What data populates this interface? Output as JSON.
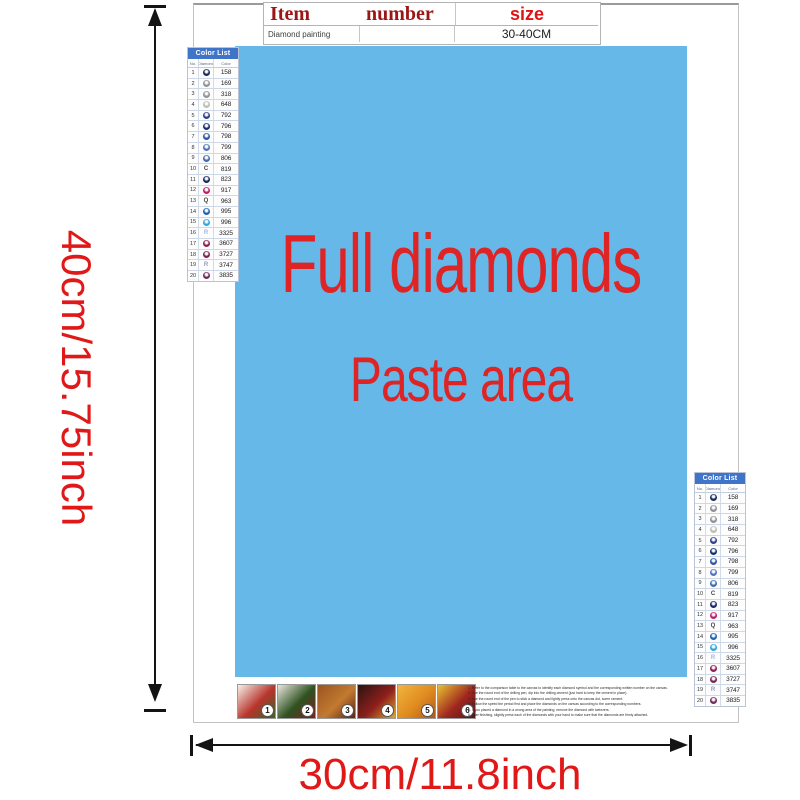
{
  "item_table": {
    "col_item": "Item",
    "col_number": "number",
    "col_size": "size",
    "row_item": "Diamond painting",
    "row_number": "",
    "row_size": "30-40CM"
  },
  "paste_area": {
    "line1": "Full diamonds",
    "line2": "Paste area",
    "bg_color": "#65b8e7",
    "text_color": "#de2424"
  },
  "dimensions": {
    "height": "40cm/15.75inch",
    "width": "30cm/11.8inch",
    "label_color": "#e01818"
  },
  "color_list": {
    "title": "Color List",
    "columns": [
      "No.",
      "Diamond",
      "Color"
    ],
    "header_bg": "#3f74c9",
    "rows": [
      {
        "no": "1",
        "type": "circle",
        "color": "#1b2a5e",
        "code": "158"
      },
      {
        "no": "2",
        "type": "circle",
        "color": "#8f9098",
        "code": "169"
      },
      {
        "no": "3",
        "type": "circle",
        "color": "#90909a",
        "code": "318"
      },
      {
        "no": "4",
        "type": "circle",
        "color": "#bfbcb4",
        "code": "648"
      },
      {
        "no": "5",
        "type": "circle",
        "color": "#2e3d8c",
        "code": "792"
      },
      {
        "no": "6",
        "type": "circle",
        "color": "#16306f",
        "code": "796"
      },
      {
        "no": "7",
        "type": "circle",
        "color": "#2c55a5",
        "code": "798"
      },
      {
        "no": "8",
        "type": "circle",
        "color": "#5273bd",
        "code": "799"
      },
      {
        "no": "9",
        "type": "circle",
        "color": "#3f6cb0",
        "code": "806"
      },
      {
        "no": "10",
        "type": "letter",
        "symbol": "C",
        "color": "#444444",
        "code": "819"
      },
      {
        "no": "11",
        "type": "circle",
        "color": "#19285f",
        "code": "823"
      },
      {
        "no": "12",
        "type": "circle",
        "color": "#bf1e6a",
        "code": "917"
      },
      {
        "no": "13",
        "type": "letter",
        "symbol": "Q",
        "color": "#444444",
        "code": "963"
      },
      {
        "no": "14",
        "type": "circle",
        "color": "#1d63b0",
        "code": "995"
      },
      {
        "no": "15",
        "type": "circle",
        "color": "#2fa5df",
        "code": "996"
      },
      {
        "no": "16",
        "type": "letter",
        "symbol": "R",
        "color": "#9dbcdc",
        "code": "3325"
      },
      {
        "no": "17",
        "type": "circle",
        "color": "#8e1d50",
        "code": "3607"
      },
      {
        "no": "18",
        "type": "circle",
        "color": "#7e2256",
        "code": "3727"
      },
      {
        "no": "19",
        "type": "letter",
        "symbol": "R",
        "color": "#8f9ec0",
        "code": "3747"
      },
      {
        "no": "20",
        "type": "circle",
        "color": "#702a5c",
        "code": "3835"
      }
    ]
  },
  "steps": [
    {
      "label": "1",
      "colors": [
        "#f6f2ea",
        "#b8342c",
        "#3a6426"
      ]
    },
    {
      "label": "2",
      "colors": [
        "#e9e6de",
        "#2e5220",
        "#7e1f1f"
      ]
    },
    {
      "label": "3",
      "colors": [
        "#9a5520",
        "#c27a30",
        "#5c2414"
      ]
    },
    {
      "label": "4",
      "colors": [
        "#2a1410",
        "#8e1f1c",
        "#e0a828"
      ]
    },
    {
      "label": "5",
      "colors": [
        "#f0b43c",
        "#e08a20",
        "#b05818"
      ]
    },
    {
      "label": "6",
      "colors": [
        "#e8c030",
        "#a02820",
        "#571317"
      ]
    }
  ],
  "instructions": {
    "lines": [
      "1. Refer to the comparison table to the canvas to identify each diamond symbol and the corresponding written number on the canvas.",
      "2. Use the round end of the drilling pen, dip into the drilling cement (just hard to keep the cement in place).",
      "3. Use the round end of the pen to stick a diamond and lightly press onto the canvas dot, some cement.",
      "4. Follow the speed the period first and place the diamonds on the canvas according to the corresponding numbers.",
      "5. If you placed a diamond in a wrong area of the painting, remove the diamond with tweezers.",
      "6. After finishing, slightly press each of the diamonds with your hand to make sure that the diamonds are firmly attached."
    ]
  }
}
